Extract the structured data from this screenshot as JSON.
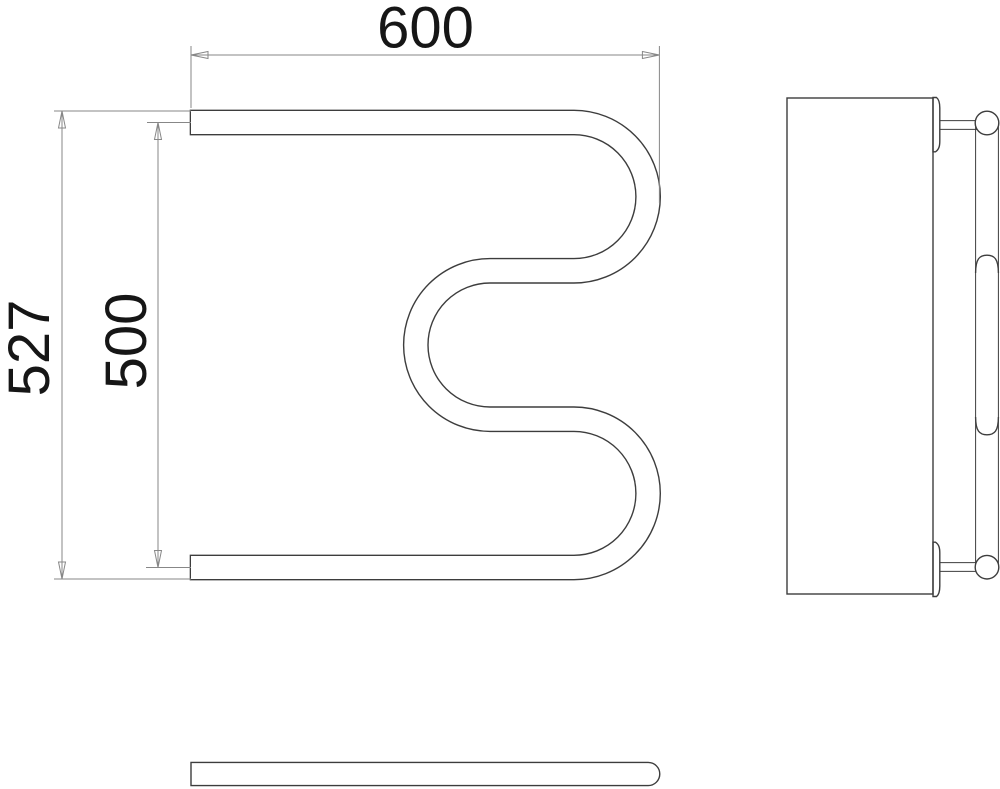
{
  "colors": {
    "background": "#ffffff",
    "drawing_line": "#3d3d3d",
    "dimension_line": "#878787",
    "label_text": "#161616",
    "panel_fill": "#ebebeb",
    "tube_fill": "#ffffff"
  },
  "dimensions": {
    "width": "600",
    "outer_height": "527",
    "axis_height": "500"
  }
}
